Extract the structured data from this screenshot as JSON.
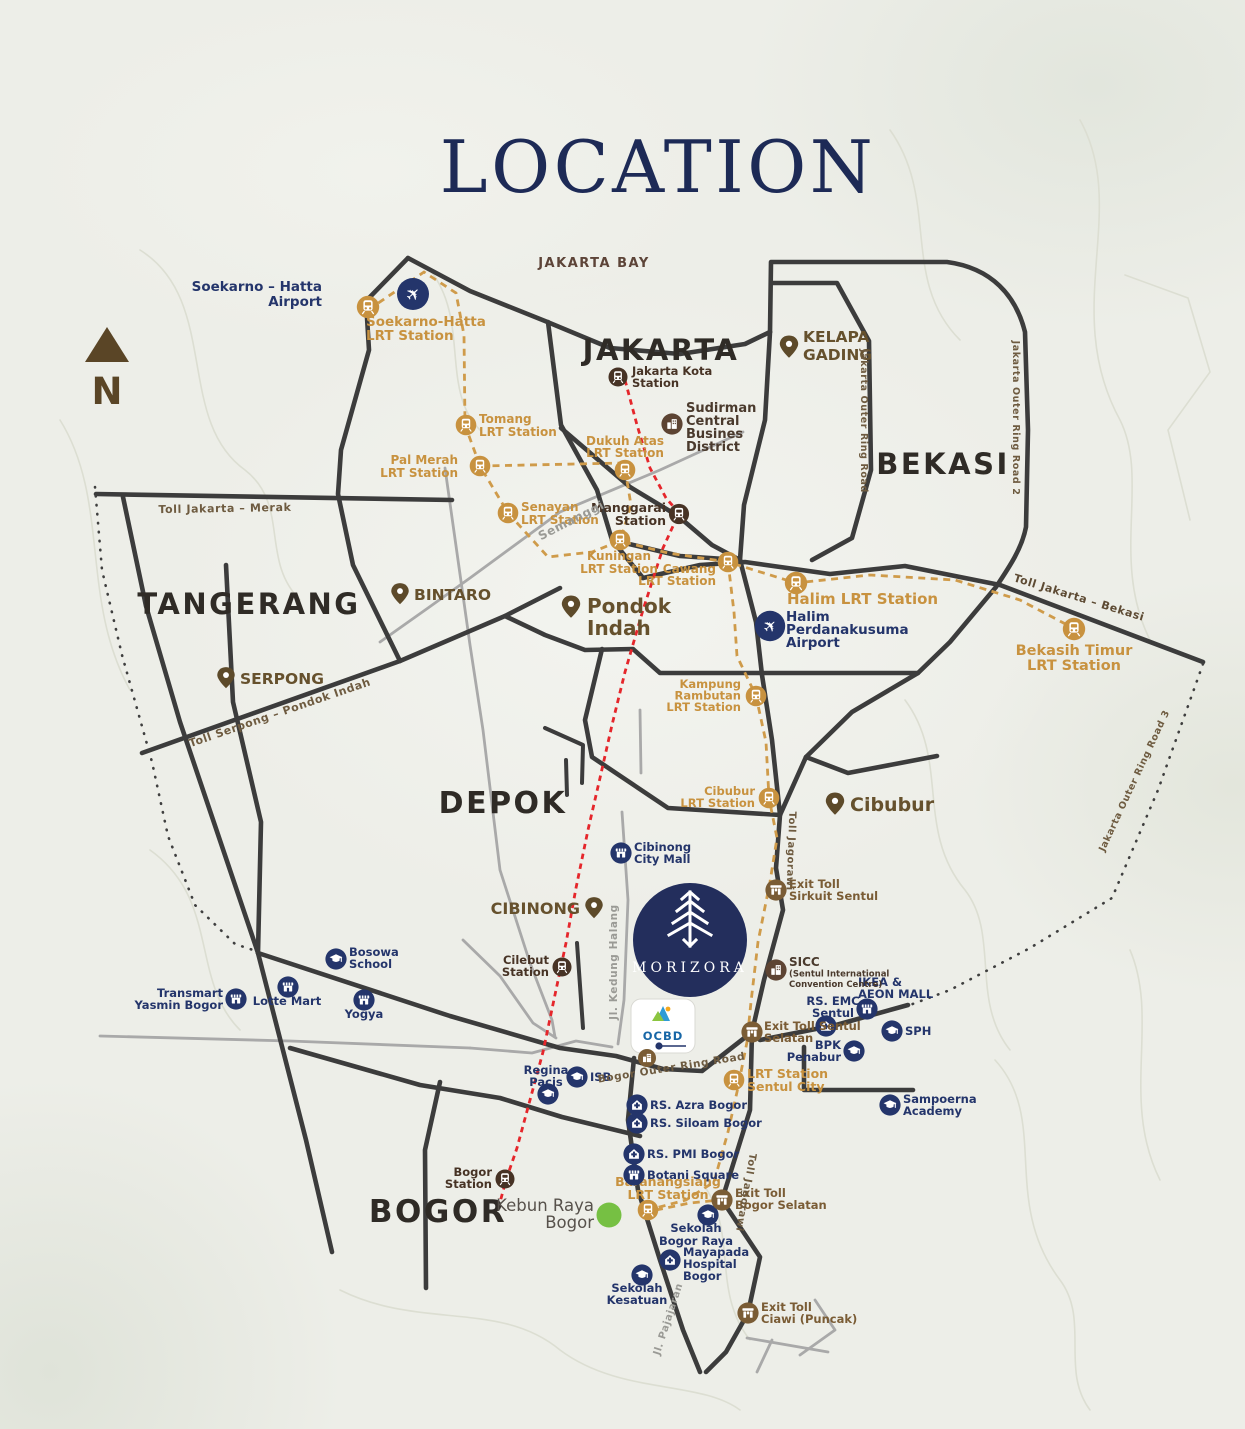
{
  "title": "LOCATION",
  "bay_label": "JAKARTA BAY",
  "compass_label": "N",
  "colors": {
    "navy": "#24356b",
    "gold": "#c8923f",
    "pin": "#5d4a2a",
    "pin_text": "#66512d",
    "toll": "#7a5c35",
    "building": "#5d4433",
    "building_text": "#4a3a2d",
    "dark_station": "#473325",
    "region": "#2f2b26",
    "road": "#3c3c3c",
    "red_line": "#e5262b",
    "lrt_line": "#cf9b4a",
    "green": "#76c043",
    "title_navy": "#1d2a56"
  },
  "regions": [
    {
      "name": "JAKARTA",
      "x": 661,
      "y": 360,
      "size": 29
    },
    {
      "name": "BEKASI",
      "x": 943,
      "y": 474,
      "size": 29
    },
    {
      "name": "TANGERANG",
      "x": 249,
      "y": 614,
      "size": 29
    },
    {
      "name": "DEPOK",
      "x": 503,
      "y": 813,
      "size": 30
    },
    {
      "name": "BOGOR",
      "x": 438,
      "y": 1222,
      "size": 31
    }
  ],
  "pins": [
    {
      "id": "kelapa-gading",
      "lines": [
        "KELAPA",
        "GADING"
      ],
      "px": 789,
      "py": 347,
      "lx": 803,
      "ly": 342,
      "anchor": "start",
      "size": 15.5,
      "dy": 18,
      "scale": 1
    },
    {
      "id": "bintaro",
      "lines": [
        "BINTARO"
      ],
      "px": 400,
      "py": 594,
      "lx": 414,
      "ly": 600,
      "anchor": "start",
      "size": 15.5,
      "dy": 17,
      "scale": 0.95
    },
    {
      "id": "serpong",
      "lines": [
        "SERPONG"
      ],
      "px": 226,
      "py": 678,
      "lx": 240,
      "ly": 684,
      "anchor": "start",
      "size": 15.5,
      "dy": 17,
      "scale": 0.95
    },
    {
      "id": "pondok-indah",
      "lines": [
        "Pondok",
        "Indah"
      ],
      "px": 571,
      "py": 607,
      "lx": 587,
      "ly": 613,
      "anchor": "start",
      "size": 20,
      "dy": 22,
      "scale": 1
    },
    {
      "id": "cibinong",
      "lines": [
        "CIBINONG"
      ],
      "px": 594,
      "py": 908,
      "lx": 580,
      "ly": 914,
      "anchor": "end",
      "size": 16,
      "dy": 17,
      "scale": 0.95
    },
    {
      "id": "cibubur",
      "lines": [
        "Cibubur"
      ],
      "px": 835,
      "py": 804,
      "lx": 850,
      "ly": 811,
      "anchor": "start",
      "size": 19,
      "dy": 20,
      "scale": 1
    }
  ],
  "airports": [
    {
      "lines": [
        "Soekarno – Hatta",
        "Airport"
      ],
      "ix": 413,
      "iy": 294,
      "s": 1,
      "lx": 322,
      "ly": 291,
      "anchor": "end",
      "size": 13.5,
      "dy": 15
    },
    {
      "lines": [
        "Halim",
        "Perdanakusuma",
        "Airport"
      ],
      "ix": 770,
      "iy": 626,
      "s": 0.95,
      "lx": 786,
      "ly": 621,
      "anchor": "start",
      "size": 13.5,
      "dy": 13
    }
  ],
  "lrt_stations": [
    {
      "lines": [
        "Soekarno-Hatta",
        "LRT Station"
      ],
      "ix": 368,
      "iy": 307,
      "lx": 366,
      "ly": 326,
      "anchor": "start",
      "size": 13.5,
      "dy": 14,
      "s": 1
    },
    {
      "lines": [
        "Tomang",
        "LRT Station"
      ],
      "ix": 466,
      "iy": 425,
      "lx": 479,
      "ly": 423,
      "anchor": "start",
      "size": 12,
      "dy": 13,
      "s": 0.92
    },
    {
      "lines": [
        "Pal Merah",
        "LRT Station"
      ],
      "ix": 480,
      "iy": 466,
      "lx": 458,
      "ly": 464,
      "anchor": "end",
      "size": 12,
      "dy": 13,
      "s": 0.92
    },
    {
      "lines": [
        "Senayan",
        "LRT Station"
      ],
      "ix": 508,
      "iy": 513,
      "lx": 521,
      "ly": 511,
      "anchor": "start",
      "size": 12,
      "dy": 13,
      "s": 0.92
    },
    {
      "lines": [
        "Dukuh Atas",
        "LRT Station"
      ],
      "ix": 625,
      "iy": 470,
      "lx": 625,
      "ly": 445,
      "anchor": "middle",
      "size": 12,
      "dy": 12,
      "s": 0.92
    },
    {
      "lines": [
        "Kuningan",
        "LRT Station"
      ],
      "ix": 620,
      "iy": 540,
      "lx": 619,
      "ly": 560,
      "anchor": "middle",
      "size": 12,
      "dy": 13,
      "s": 0.92
    },
    {
      "lines": [
        "Cawang",
        "LRT Station"
      ],
      "ix": 728,
      "iy": 562,
      "lx": 716,
      "ly": 573,
      "anchor": "end",
      "size": 12,
      "dy": 12,
      "s": 0.92
    },
    {
      "lines": [
        "Halim LRT Station"
      ],
      "ix": 796,
      "iy": 583,
      "lx": 787,
      "ly": 604,
      "anchor": "start",
      "size": 15,
      "dy": 15,
      "s": 1
    },
    {
      "lines": [
        "Kampung",
        "Rambutan",
        "LRT Station"
      ],
      "ix": 756,
      "iy": 696,
      "lx": 741,
      "ly": 688,
      "anchor": "end",
      "size": 11.5,
      "dy": 11.5,
      "s": 0.92
    },
    {
      "lines": [
        "Cibubur",
        "LRT Station"
      ],
      "ix": 769,
      "iy": 798,
      "lx": 755,
      "ly": 795,
      "anchor": "end",
      "size": 11.5,
      "dy": 12,
      "s": 0.92
    },
    {
      "lines": [
        "Bekasih Timur",
        "LRT Station"
      ],
      "ix": 1074,
      "iy": 629,
      "lx": 1074,
      "ly": 655,
      "anchor": "middle",
      "size": 14.5,
      "dy": 15,
      "s": 1
    },
    {
      "lines": [
        "LRT Station",
        "Sentul City"
      ],
      "ix": 734,
      "iy": 1080,
      "lx": 747,
      "ly": 1078,
      "anchor": "start",
      "size": 12.5,
      "dy": 13,
      "s": 0.92
    },
    {
      "lines": [
        "Baranangsiang",
        "LRT Station"
      ],
      "ix": 648,
      "iy": 1210,
      "lx": 668,
      "ly": 1186,
      "anchor": "middle",
      "size": 12.5,
      "dy": 13,
      "s": 0.92
    }
  ],
  "train_stations": [
    {
      "lines": [
        "Jakarta Kota",
        "Station"
      ],
      "ix": 618,
      "iy": 377,
      "lx": 632,
      "ly": 375,
      "anchor": "start",
      "size": 11.5,
      "dy": 12,
      "s": 0.85
    },
    {
      "lines": [
        "Manggarai",
        "Station"
      ],
      "ix": 679,
      "iy": 514,
      "lx": 666,
      "ly": 512,
      "anchor": "end",
      "size": 12.5,
      "dy": 13,
      "s": 0.9
    },
    {
      "lines": [
        "Cilebut",
        "Station"
      ],
      "ix": 562,
      "iy": 967,
      "lx": 549,
      "ly": 964,
      "anchor": "end",
      "size": 11.5,
      "dy": 12,
      "s": 0.85
    },
    {
      "lines": [
        "Bogor",
        "Station"
      ],
      "ix": 505,
      "iy": 1179,
      "lx": 492,
      "ly": 1176,
      "anchor": "end",
      "size": 11.5,
      "dy": 12,
      "s": 0.85
    }
  ],
  "pois": [
    {
      "type": "school",
      "lines": [
        "Bosowa",
        "School"
      ],
      "ix": 336,
      "iy": 959,
      "lx": 349,
      "ly": 956,
      "anchor": "start",
      "size": 11.5,
      "dy": 12
    },
    {
      "type": "school",
      "lines": [
        "Regina",
        "Pacis"
      ],
      "ix": 548,
      "iy": 1094,
      "lx": 546,
      "ly": 1074,
      "anchor": "middle",
      "size": 11.5,
      "dy": 12
    },
    {
      "type": "school",
      "lines": [
        "ISB"
      ],
      "ix": 577,
      "iy": 1077,
      "lx": 590,
      "ly": 1081,
      "anchor": "start",
      "size": 11.5,
      "dy": 12
    },
    {
      "type": "school",
      "lines": [
        "Sekolah",
        "Bogor Raya"
      ],
      "ix": 708,
      "iy": 1215,
      "lx": 696,
      "ly": 1232,
      "anchor": "middle",
      "size": 11.5,
      "dy": 13
    },
    {
      "type": "school",
      "lines": [
        "Sekolah",
        "Kesatuan"
      ],
      "ix": 642,
      "iy": 1275,
      "lx": 637,
      "ly": 1292,
      "anchor": "middle",
      "size": 11.5,
      "dy": 12
    },
    {
      "type": "school",
      "lines": [
        "SPH"
      ],
      "ix": 892,
      "iy": 1031,
      "lx": 905,
      "ly": 1035,
      "anchor": "start",
      "size": 11.5,
      "dy": 12
    },
    {
      "type": "school",
      "lines": [
        "BPK",
        "Penabur"
      ],
      "ix": 854,
      "iy": 1051,
      "lx": 841,
      "ly": 1049,
      "anchor": "end",
      "size": 11.5,
      "dy": 12
    },
    {
      "type": "school",
      "lines": [
        "Sampoerna",
        "Academy"
      ],
      "ix": 890,
      "iy": 1105,
      "lx": 903,
      "ly": 1103,
      "anchor": "start",
      "size": 11.5,
      "dy": 12
    },
    {
      "type": "hospital",
      "lines": [
        "RS. EMC",
        "Sentul"
      ],
      "ix": 826,
      "iy": 1026,
      "lx": 833,
      "ly": 1005,
      "anchor": "middle",
      "size": 11.5,
      "dy": 12
    },
    {
      "type": "hospital",
      "lines": [
        "RS. Azra Bogor"
      ],
      "ix": 637,
      "iy": 1105,
      "lx": 650,
      "ly": 1109,
      "anchor": "start",
      "size": 11.5,
      "dy": 12
    },
    {
      "type": "hospital",
      "lines": [
        "RS. Siloam Bogor"
      ],
      "ix": 637,
      "iy": 1123,
      "lx": 650,
      "ly": 1127,
      "anchor": "start",
      "size": 11.5,
      "dy": 12
    },
    {
      "type": "hospital",
      "lines": [
        "RS. PMI Bogor"
      ],
      "ix": 634,
      "iy": 1154,
      "lx": 647,
      "ly": 1158,
      "anchor": "start",
      "size": 11.5,
      "dy": 12
    },
    {
      "type": "hospital",
      "lines": [
        "Mayapada",
        "Hospital",
        "Bogor"
      ],
      "ix": 670,
      "iy": 1260,
      "lx": 683,
      "ly": 1256,
      "anchor": "start",
      "size": 11.5,
      "dy": 12
    },
    {
      "type": "mall",
      "lines": [
        "Transmart",
        "Yasmin Bogor"
      ],
      "ix": 236,
      "iy": 999,
      "lx": 223,
      "ly": 997,
      "anchor": "end",
      "size": 11.5,
      "dy": 12
    },
    {
      "type": "mall",
      "lines": [
        "Lotte Mart"
      ],
      "ix": 288,
      "iy": 987,
      "lx": 287,
      "ly": 1005,
      "anchor": "middle",
      "size": 11.5,
      "dy": 12
    },
    {
      "type": "mall",
      "lines": [
        "Yogya"
      ],
      "ix": 364,
      "iy": 1000,
      "lx": 364,
      "ly": 1018,
      "anchor": "middle",
      "size": 11.5,
      "dy": 12
    },
    {
      "type": "mall",
      "lines": [
        "Cibinong",
        "City Mall"
      ],
      "ix": 621,
      "iy": 853,
      "lx": 634,
      "ly": 851,
      "anchor": "start",
      "size": 11.5,
      "dy": 12
    },
    {
      "type": "mall",
      "lines": [
        "Botani Square"
      ],
      "ix": 634,
      "iy": 1175,
      "lx": 647,
      "ly": 1179,
      "anchor": "start",
      "size": 11.5,
      "dy": 12
    },
    {
      "type": "mall",
      "lines": [
        "IKEA &",
        "AEON MALL"
      ],
      "ix": 867,
      "iy": 1009,
      "lx": 858,
      "ly": 986,
      "anchor": "start",
      "size": 11.5,
      "dy": 12
    },
    {
      "type": "toll",
      "lines": [
        "Exit Toll",
        "Sirkuit Sentul"
      ],
      "ix": 776,
      "iy": 890,
      "lx": 789,
      "ly": 888,
      "anchor": "start",
      "size": 11.5,
      "dy": 12
    },
    {
      "type": "toll",
      "lines": [
        "Exit Toll Sentul",
        "Selatan"
      ],
      "ix": 752,
      "iy": 1032,
      "lx": 764,
      "ly": 1030,
      "anchor": "start",
      "size": 11.5,
      "dy": 12
    },
    {
      "type": "toll",
      "lines": [
        "Exit Toll",
        "Bogor Selatan"
      ],
      "ix": 722,
      "iy": 1200,
      "lx": 735,
      "ly": 1197,
      "anchor": "start",
      "size": 11.5,
      "dy": 12
    },
    {
      "type": "toll",
      "lines": [
        "Exit Toll",
        "Ciawi (Puncak)"
      ],
      "ix": 748,
      "iy": 1313,
      "lx": 761,
      "ly": 1311,
      "anchor": "start",
      "size": 11.5,
      "dy": 12
    },
    {
      "type": "building",
      "lines": [
        "Sudirman",
        "Central",
        "Busines",
        "District"
      ],
      "ix": 672,
      "iy": 424,
      "lx": 686,
      "ly": 412,
      "anchor": "start",
      "size": 13,
      "dy": 13
    },
    {
      "type": "building",
      "lines": [
        "SICC",
        "(Sentul International",
        "Convention Centre)"
      ],
      "sizes": [
        12,
        8.5,
        8.5
      ],
      "ix": 776,
      "iy": 970,
      "lx": 789,
      "ly": 966,
      "anchor": "start",
      "size": 12,
      "dy": 10.5
    }
  ],
  "road_labels": [
    {
      "text": "Toll Jakarta – Merak",
      "x": 225,
      "y": 512,
      "rot": -1,
      "size": 11,
      "color": "#6e5b40"
    },
    {
      "text": "Toll Serpong – Pondok Indah",
      "x": 281,
      "y": 716,
      "rot": -19,
      "size": 11,
      "color": "#6e5b40"
    },
    {
      "text": "Semanggi",
      "x": 573,
      "y": 524,
      "rot": -27,
      "size": 12,
      "color": "#9a9a95"
    },
    {
      "text": "Jakarta Outer Ring Road",
      "x": 861,
      "y": 421,
      "rot": 90,
      "size": 9.5,
      "color": "#6e5b40"
    },
    {
      "text": "Jakarta Outer Ring Road 2",
      "x": 1013,
      "y": 418,
      "rot": 90,
      "size": 9.5,
      "color": "#6e5b40"
    },
    {
      "text": "Toll Jakarta – Bekasi",
      "x": 1078,
      "y": 601,
      "rot": 17,
      "size": 11,
      "color": "#5d4a33"
    },
    {
      "text": "Jakarta Outer Ring Road 3",
      "x": 1137,
      "y": 782,
      "rot": -65,
      "size": 9.5,
      "color": "#6e5b40"
    },
    {
      "text": "Toll Jagorawi",
      "x": 788,
      "y": 851,
      "rot": 92,
      "size": 10,
      "color": "#6e5b40"
    },
    {
      "text": "Toll Jagorawi",
      "x": 743,
      "y": 1192,
      "rot": 100,
      "size": 10,
      "color": "#6e5b40"
    },
    {
      "text": "Bogor Outer Ring Road",
      "x": 672,
      "y": 1071,
      "rot": -9,
      "size": 10.5,
      "color": "#6e5b40"
    },
    {
      "text": "Jl. Kedung Halang",
      "x": 617,
      "y": 962,
      "rot": -90,
      "size": 10.5,
      "color": "#9a9a95"
    },
    {
      "text": "Jl. Pajajaran",
      "x": 671,
      "y": 1320,
      "rot": -72,
      "size": 10,
      "color": "#9a9a95"
    }
  ],
  "morizora": {
    "name": "MORIZORA",
    "cx": 690,
    "cy": 940,
    "r": 57
  },
  "ocbd": {
    "name": "OCBD"
  },
  "kebun_raya": {
    "lines": [
      "Kebun Raya",
      "Bogor"
    ],
    "cx": 609,
    "cy": 1215,
    "r": 12.5,
    "lx": 594,
    "ly": 1211,
    "dy": 17,
    "size": 16.5,
    "color": "#57514b"
  }
}
